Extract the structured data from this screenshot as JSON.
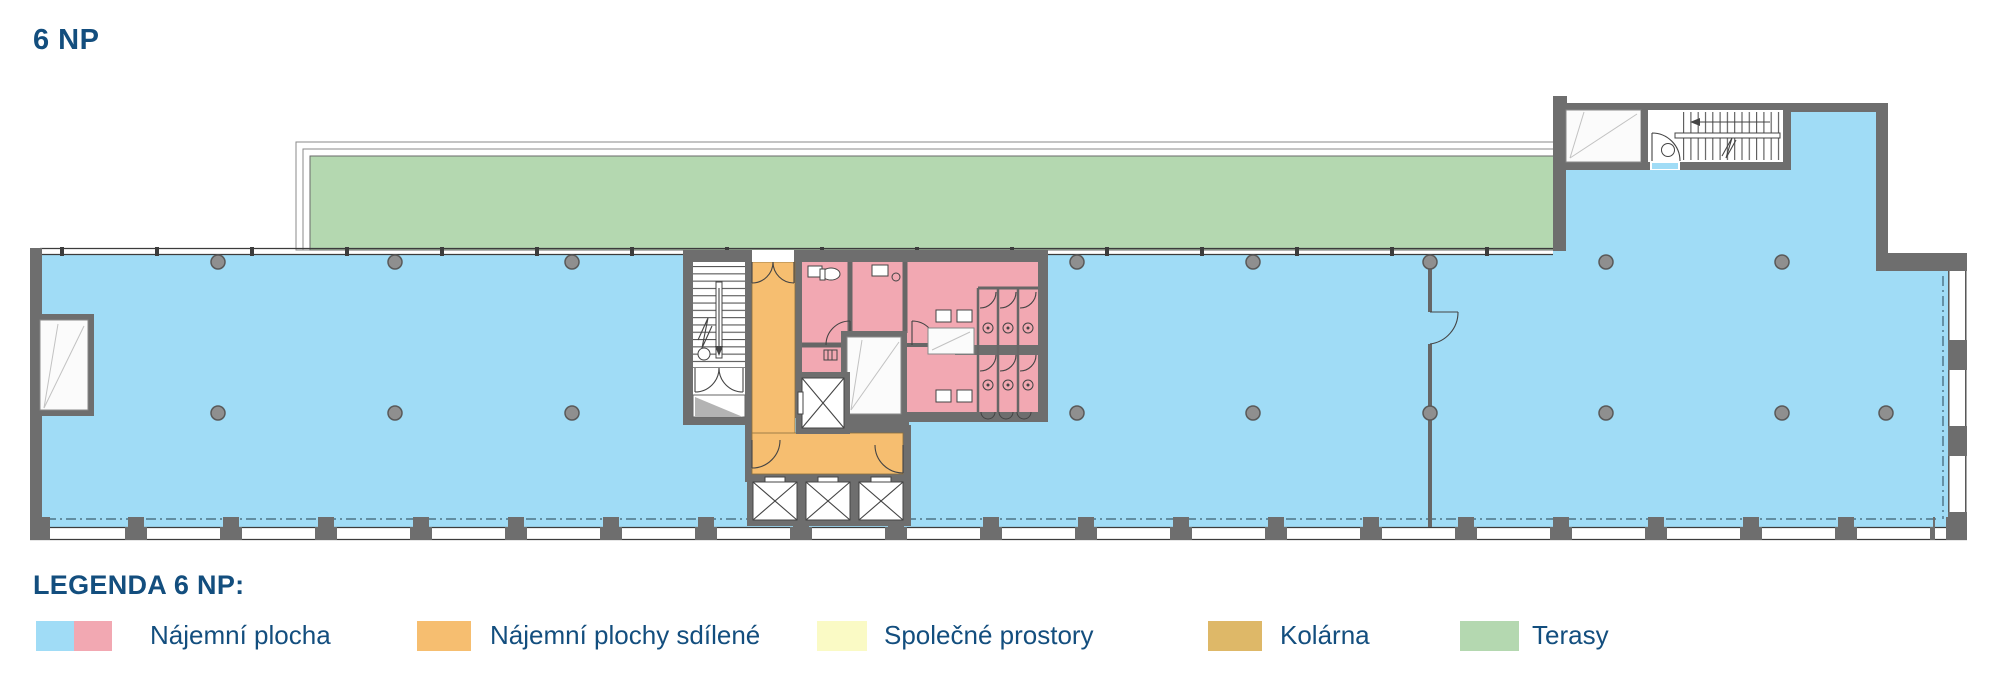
{
  "title": "6 NP",
  "legend": {
    "heading": "LEGENDA 6 NP:",
    "items": [
      {
        "label": "Nájemní plocha",
        "swatch": "dual-blue-pink"
      },
      {
        "label": "Nájemní plochy sdílené",
        "swatch": "orange"
      },
      {
        "label": "Společné prostory",
        "swatch": "yellow"
      },
      {
        "label": "Kolárna",
        "swatch": "tan"
      },
      {
        "label": "Terasy",
        "swatch": "green"
      }
    ]
  },
  "colors": {
    "rental_blue": "#A0DCF6",
    "rental_pink": "#F2A8B2",
    "shared_orange": "#F6BE70",
    "common_yellow": "#FAFAC5",
    "bike_tan": "#DEB868",
    "terrace_green": "#B4D8B0",
    "wall_gray": "#6E6E6E",
    "line_dark": "#3C3C3C",
    "dash_line": "#3E5F70",
    "text_blue": "#134E7E"
  }
}
